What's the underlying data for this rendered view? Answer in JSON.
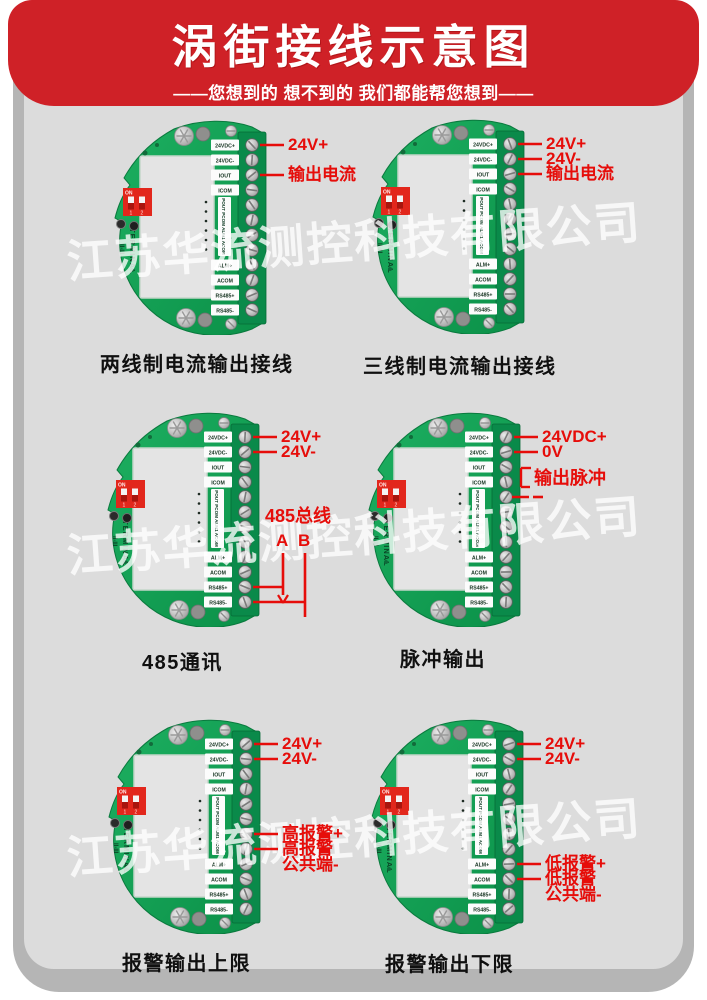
{
  "header": {
    "title": "涡街接线示意图",
    "subtitle": "——您想到的 想不到的 我们都能帮您想到——"
  },
  "watermark": {
    "text": "江苏华流测控科技有限公司"
  },
  "terminal_labels": {
    "top": [
      "24VDC+",
      "24VDC-",
      "IOUT",
      "ICOM"
    ],
    "side": "POUT PCOM ALM1 ACOM",
    "bottom": [
      "ALM+",
      "ACOM",
      "RS485+",
      "RS485-"
    ]
  },
  "dip_switch": {
    "on_label": "ON",
    "pos1": "1",
    "pos2": "2"
  },
  "silkscreen": {
    "terminal": "TERMINAL",
    "model": "II-III"
  },
  "colors": {
    "banner_red": "#cf2127",
    "annotation_red": "#e60d0a",
    "pcb_green": "#12a254",
    "terminal_block_green": "#0a8a4a",
    "panel_gray": "#dcdcdc",
    "dip_red": "#e2271c"
  },
  "boards": [
    {
      "caption": "两线制电流输出接线",
      "annotations": [
        {
          "type": "lead",
          "label": "24V+",
          "row": 1
        },
        {
          "type": "lead",
          "label": "输出电流",
          "row": 3
        }
      ]
    },
    {
      "caption": "三线制电流输出接线",
      "annotations": [
        {
          "type": "lead",
          "label": "24V+",
          "row": 1
        },
        {
          "type": "lead",
          "label": "24V-",
          "row": 2
        },
        {
          "type": "lead",
          "label": "输出电流",
          "row": 3
        }
      ]
    },
    {
      "caption": "485通讯",
      "annotations": [
        {
          "type": "lead",
          "label": "24V+",
          "row": 1
        },
        {
          "type": "lead",
          "label": "24V-",
          "row": 2
        },
        {
          "type": "bus485",
          "title": "485总线",
          "line_a": "A",
          "line_b": "B",
          "row_a": 11,
          "row_b": 12
        }
      ]
    },
    {
      "caption": "脉冲输出",
      "annotations": [
        {
          "type": "lead",
          "label": "24VDC+",
          "row": 1
        },
        {
          "type": "lead",
          "label": "0V",
          "row": 2
        },
        {
          "type": "bracket",
          "label": "输出脉冲"
        }
      ]
    },
    {
      "caption": "报警输出上限",
      "annotations": [
        {
          "type": "lead",
          "label": "24V+",
          "row": 1
        },
        {
          "type": "lead",
          "label": "24V-",
          "row": 2
        },
        {
          "type": "lead",
          "label": "高报警+",
          "row": 7
        },
        {
          "type": "lead2",
          "label": "高报警",
          "label2": "公共端-",
          "row": 8
        }
      ]
    },
    {
      "caption": "报警输出下限",
      "annotations": [
        {
          "type": "lead",
          "label": "24V+",
          "row": 1
        },
        {
          "type": "lead",
          "label": "24V-",
          "row": 2
        },
        {
          "type": "lead",
          "label": "低报警+",
          "row": 9
        },
        {
          "type": "lead2",
          "label": "低报警",
          "label2": "公共端-",
          "row": 10
        }
      ]
    }
  ]
}
